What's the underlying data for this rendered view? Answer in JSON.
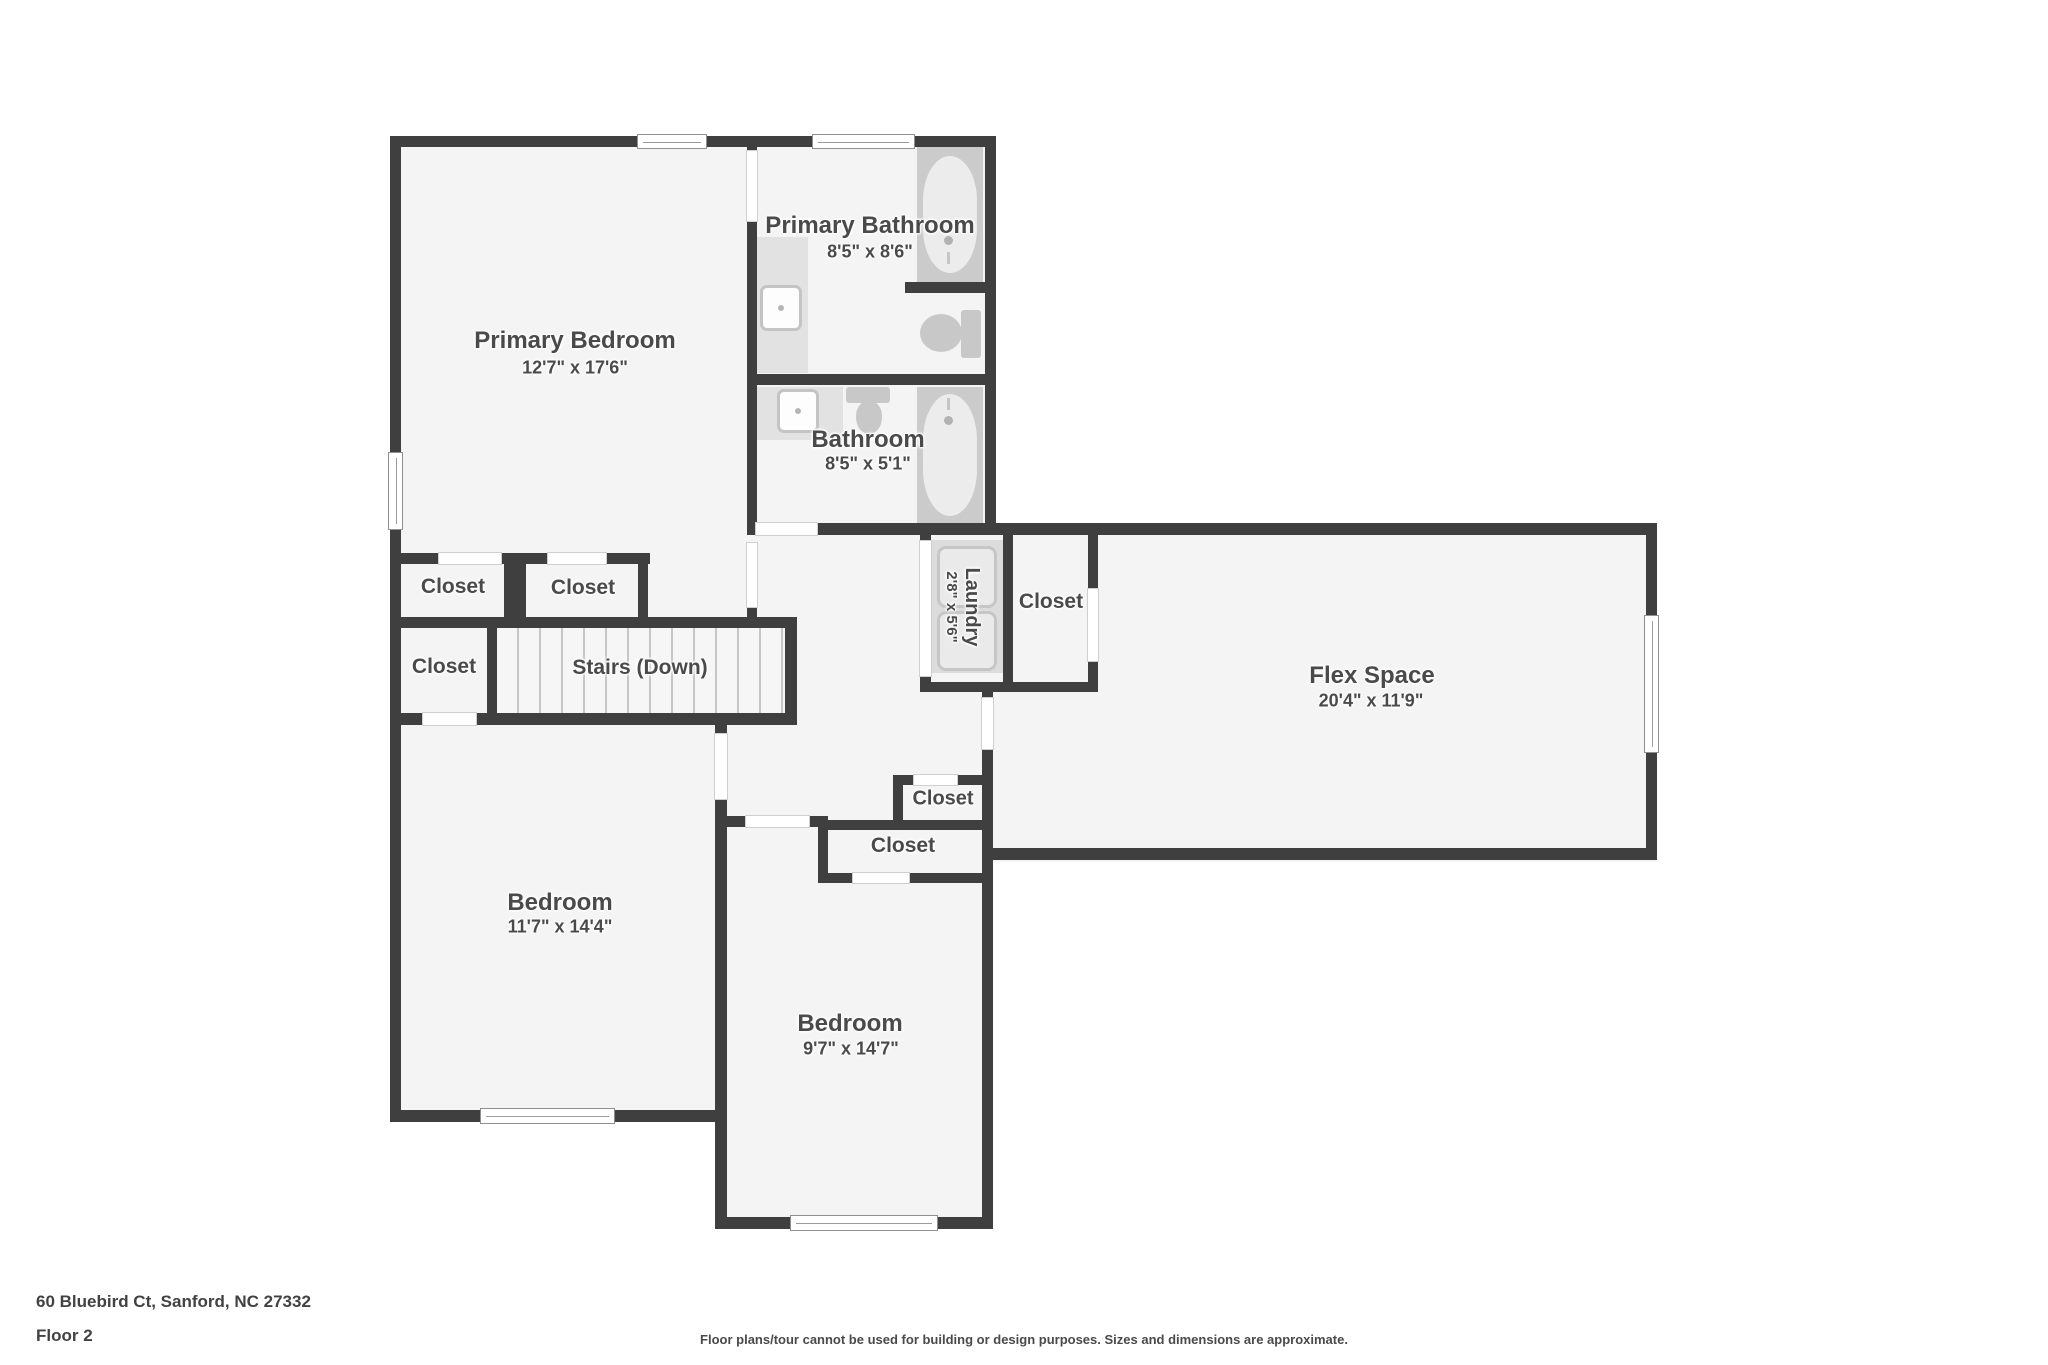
{
  "footer": {
    "address": "60 Bluebird Ct, Sanford, NC 27332",
    "floor": "Floor 2",
    "disclaimer": "Floor plans/tour cannot be used for building or design purposes. Sizes and dimensions are approximate."
  },
  "rooms": {
    "primary_bedroom": {
      "name": "Primary Bedroom",
      "dims": "12'7\" x 17'6\""
    },
    "primary_bathroom": {
      "name": "Primary Bathroom",
      "dims": "8'5\" x 8'6\""
    },
    "bathroom": {
      "name": "Bathroom",
      "dims": "8'5\" x 5'1\""
    },
    "laundry": {
      "name": "Laundry",
      "dims": "2'8\" x 5'6\""
    },
    "flex_space": {
      "name": "Flex Space",
      "dims": "20'4\" x 11'9\""
    },
    "bedroom_left": {
      "name": "Bedroom",
      "dims": "11'7\" x 14'4\""
    },
    "bedroom_right": {
      "name": "Bedroom",
      "dims": "9'7\" x 14'7\""
    },
    "stairs": {
      "name": "Stairs (Down)"
    }
  },
  "labels": {
    "closet": "Closet"
  },
  "colors": {
    "wall": "#3f3f3f",
    "room_fill": "#f4f4f4",
    "fixture": "#c9c9c9",
    "label_text": "#4a4a4a",
    "background": "#ffffff"
  }
}
